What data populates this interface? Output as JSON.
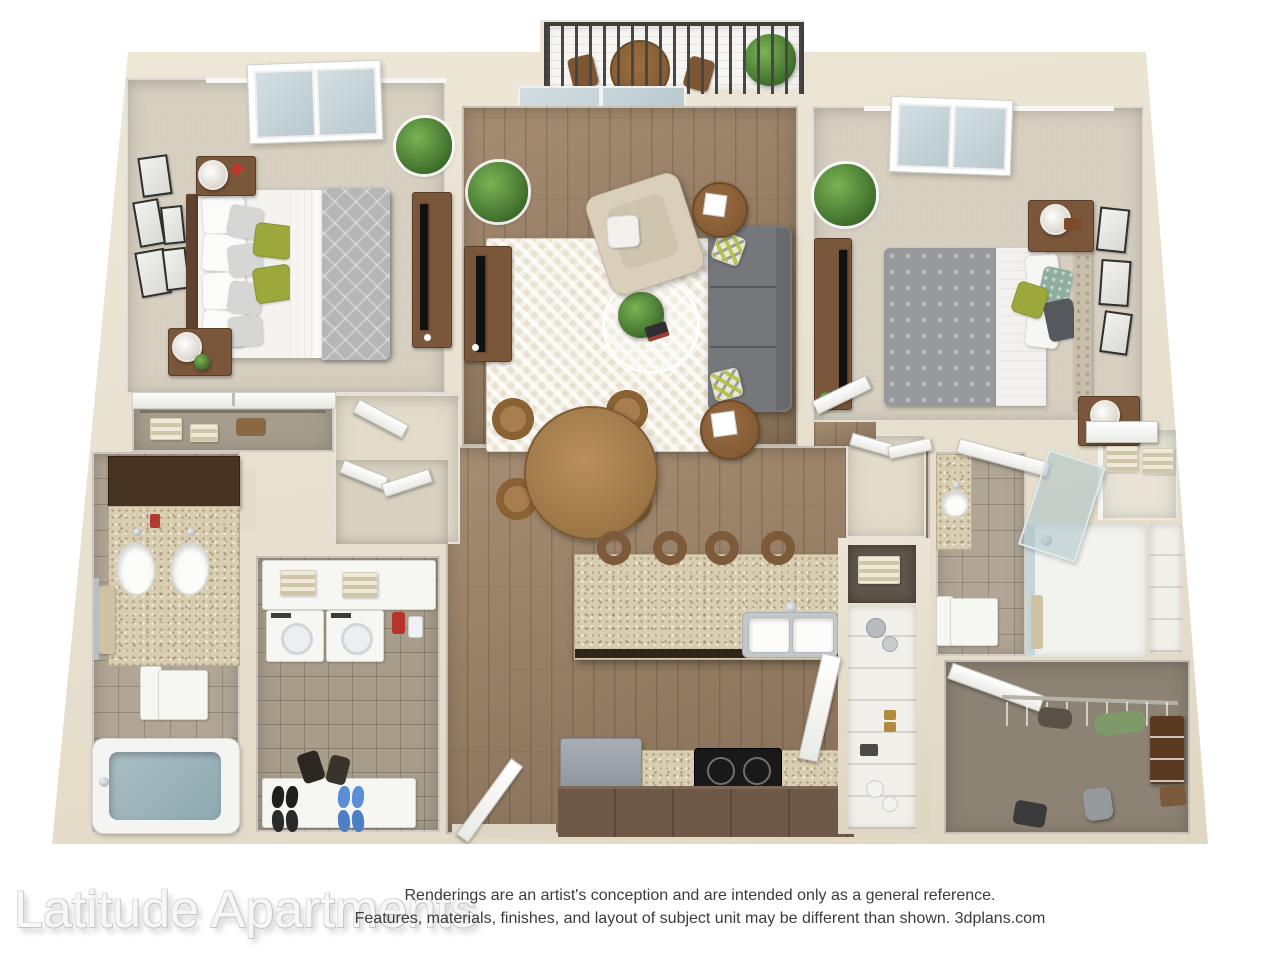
{
  "caption": {
    "watermark": "Latitude Apartments",
    "disclaimer_line_1": "Renderings are an artist's conception and are intended only as a general reference.",
    "disclaimer_line_2": "Features, materials, finishes, and layout of subject unit may be different than shown. 3dplans.com"
  },
  "palette": {
    "background": "#ffffff",
    "wall_cream": "#e9e2d1",
    "wall_shadow": "#ded5c0",
    "wood_floor": "#9c8164",
    "bedroom_carpet": "#d6cfc0",
    "bathroom_tile": "#b1a695",
    "utility_tile": "#a89d8b",
    "closet_floor_taupe": "#8d8374",
    "granite_counter": "#d8cdb0",
    "dark_vanity_cabinet": "#473322",
    "furniture_wood": "#7a573b",
    "walnut_table": "#8a5f3a",
    "sofa_gray": "#75777a",
    "comforter_gray": "#b6b6b6",
    "accent_green_pillow": "#9ca73c",
    "plant_green": "#4c7e35",
    "tub_water": "#9db6bd",
    "balcony_railing": "#3f3f3f",
    "deck_white": "#f7f6f3",
    "rug_cream": "#e9e2d0",
    "stove_black": "#191919",
    "fridge_gray": "#9ba2a7",
    "watermark_text": "#f7f7f7",
    "disclaimer_text": "#3c3c3c"
  },
  "floorplan": {
    "view": "3d-top-down-rendering",
    "unit_type": "2 bedroom / 2 bathroom with balcony",
    "rooms": [
      {
        "name": "balcony",
        "features": [
          "railing",
          "bistro-table",
          "folding-chairs",
          "plant"
        ]
      },
      {
        "name": "living-room",
        "features": [
          "sofa",
          "armchair",
          "area-rug",
          "coffee-table-plant",
          "tv-console",
          "side-tables",
          "sliding-glass-door"
        ]
      },
      {
        "name": "bedroom-1",
        "features": [
          "bed-green-pillows",
          "nightstands-with-lamps",
          "skylight",
          "gallery-frames",
          "tv-console",
          "sliding-door-closet"
        ]
      },
      {
        "name": "bedroom-2",
        "features": [
          "bed-gray-comforter",
          "tufted-headboard",
          "nightstands-with-lamps",
          "skylight",
          "wall-frames",
          "tv-console"
        ]
      },
      {
        "name": "dining-area",
        "features": [
          "round-table",
          "four-chairs"
        ]
      },
      {
        "name": "kitchen",
        "features": [
          "granite-island",
          "double-sink",
          "four-bar-stools",
          "refrigerator",
          "cooktop-stove",
          "pantry"
        ]
      },
      {
        "name": "bathroom-1",
        "features": [
          "double-vanity",
          "toilet",
          "bathtub",
          "towel-bar"
        ]
      },
      {
        "name": "bathroom-2",
        "features": [
          "vessel-sink-vanity",
          "toilet",
          "walk-in-shower"
        ]
      },
      {
        "name": "laundry-utility-closet",
        "features": [
          "washer",
          "dryer",
          "towel-shelf",
          "shoe-shelf"
        ]
      },
      {
        "name": "walk-in-closet",
        "features": [
          "clothes-rod",
          "shoe-organizer",
          "bags"
        ]
      },
      {
        "name": "linen-closet",
        "features": [
          "towel-stacks"
        ]
      },
      {
        "name": "entry",
        "features": [
          "front-door"
        ]
      }
    ]
  }
}
